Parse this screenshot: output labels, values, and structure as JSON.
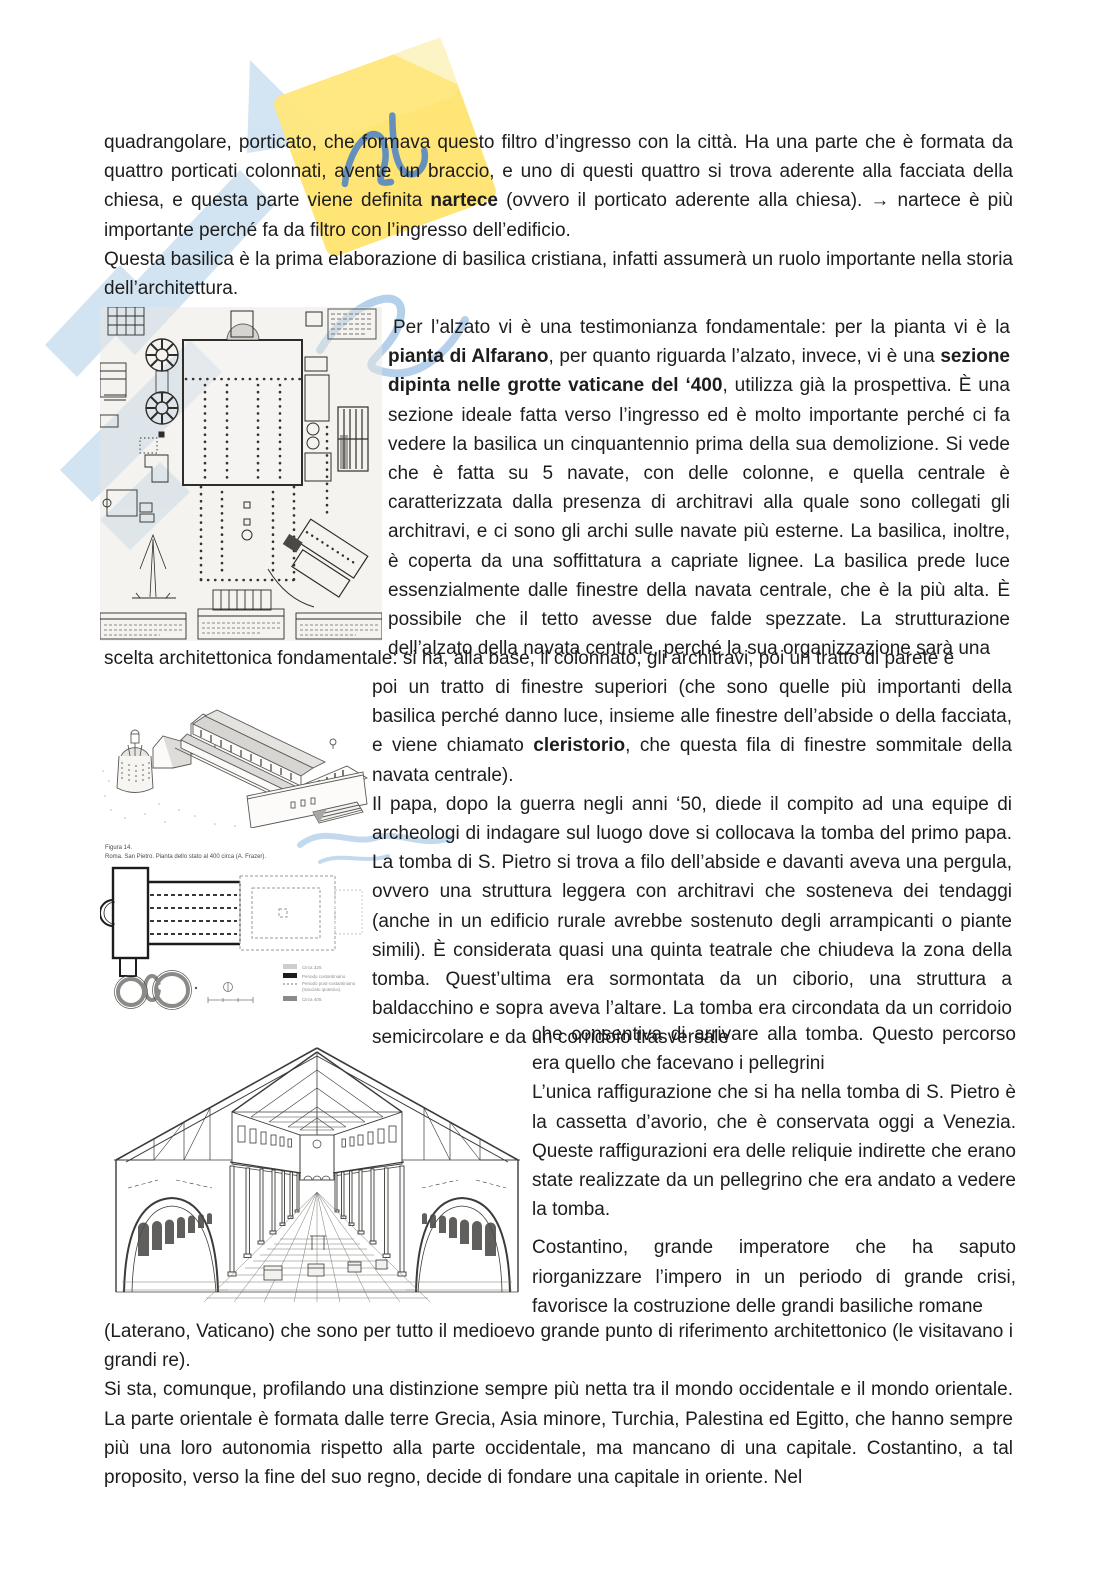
{
  "page": {
    "background": "#ffffff",
    "text_color": "#1d1d1d",
    "language": "it"
  },
  "watermark": {
    "name": "skuolanet-watermark",
    "yellow": "#ffdf5e",
    "light_blue": "#aecde9",
    "script_blue": "#4c86cd"
  },
  "text": {
    "p1": [
      {
        "t": "quadrangolare, porticato, che formava questo filtro d’ingresso con la città. Ha una parte che è formata da quattro porticati colonnati, avente un braccio, e uno di questi quattro si trova aderente alla facciata della chiesa, e questa parte viene definita "
      },
      {
        "t": "nartece"
      },
      {
        "t": " (ovvero il porticato aderente alla chiesa). → nartece è più importante perché fa da filtro con l’ingresso dell’edificio."
      }
    ],
    "p2": "Questa basilica è la prima elaborazione di basilica cristiana, infatti assumerà un ruolo importante nella storia dell’architettura.",
    "p3": [
      {
        "t": "Per l’alzato vi è una testimonianza fondamentale: per la pianta vi è la "
      },
      {
        "t": "pianta di Alfarano"
      },
      {
        "t": ", per quanto riguarda l’alzato, invece, vi è una "
      },
      {
        "t": "sezione dipinta nelle grotte vaticane del ‘400"
      },
      {
        "t": ", utilizza già la prospettiva. È una sezione ideale fatta verso l’ingresso ed è molto importante perché ci fa vedere la basilica un cinquantennio prima della sua demolizione. Si vede che è fatta su 5 navate, con delle colonne, e quella centrale è caratterizzata dalla presenza di architravi alla quale sono collegati gli architravi, e ci sono gli archi sulle navate più esterne. La basilica, inoltre, è coperta da una soffittatura a capriate lignee. La basilica prede luce essenzialmente dalle finestre della navata centrale, che è la più alta. È possibile che il tetto avesse due falde spezzate. La strutturazione dell’alzato della navata centrale, perché la sua organizzazione sarà una"
      }
    ],
    "p4": "scelta architettonica fondamentale: si ha, alla base, il colonnato, gli architravi, poi un tratto di parete e",
    "p5": [
      {
        "t": "poi un tratto di finestre superiori (che sono quelle più importanti della basilica perché danno luce, insieme alle finestre dell’abside o della facciata, e viene chiamato "
      },
      {
        "t": "cleristorio"
      },
      {
        "t": ", che questa fila di finestre sommitale della navata centrale)."
      }
    ],
    "p6": "Il papa, dopo la guerra negli anni ‘50, diede il compito ad una equipe di archeologi di indagare sul luogo dove si collocava la tomba del primo papa. La tomba di S. Pietro si trova a filo dell’abside e davanti aveva una pergula, ovvero una struttura leggera con architravi che sosteneva dei tendaggi (anche in un edificio rurale avrebbe sostenuto degli arrampicanti o piante simili). È considerata quasi una quinta teatrale che chiudeva la zona della tomba. Quest’ultima era sormontata da un ciborio, una struttura a baldacchino e sopra aveva l’altare. La tomba era circondata da un corridoio semicircolare e da un corridoio trasversale",
    "p7": "che consentiva di arrivare alla tomba. Questo percorso era quello che facevano i pellegrini",
    "p8": "L’unica raffigurazione che si ha nella tomba di S. Pietro è la cassetta d’avorio, che è conservata oggi a Venezia. Queste raffigurazioni era delle reliquie indirette che erano state realizzate da un pellegrino che era andato a vedere la tomba.",
    "p9": "Costantino, grande imperatore che ha saputo riorganizzare l’impero in un periodo di grande crisi, favorisce la costruzione delle grandi basiliche romane",
    "p10": "(Laterano, Vaticano) che sono per tutto il medioevo grande punto di riferimento architettonico (le visitavano i grandi re).",
    "p11": "Si sta, comunque,  profilando una distinzione sempre più netta tra il mondo occidentale e il mondo orientale. La parte orientale è formata dalle terre Grecia, Asia minore, Turchia, Palestina ed Egitto, che hanno sempre più una loro autonomia rispetto alla parte occidentale, ma mancano di una capitale. Costantino, a tal proposito, verso la fine del suo regno, decide di fondare una capitale in oriente. Nel"
  },
  "figures": {
    "fig14": {
      "caption1": "Figura 14.",
      "caption2": "Roma. San Pietro. Pianta dello stato al 400 circa (A. Frazer).",
      "legend": [
        "Circa 320.",
        "Periodo costantiniano.",
        "Periodo post-costantiniano",
        "(tracciato ipotetico).",
        "Circa 400."
      ]
    }
  }
}
